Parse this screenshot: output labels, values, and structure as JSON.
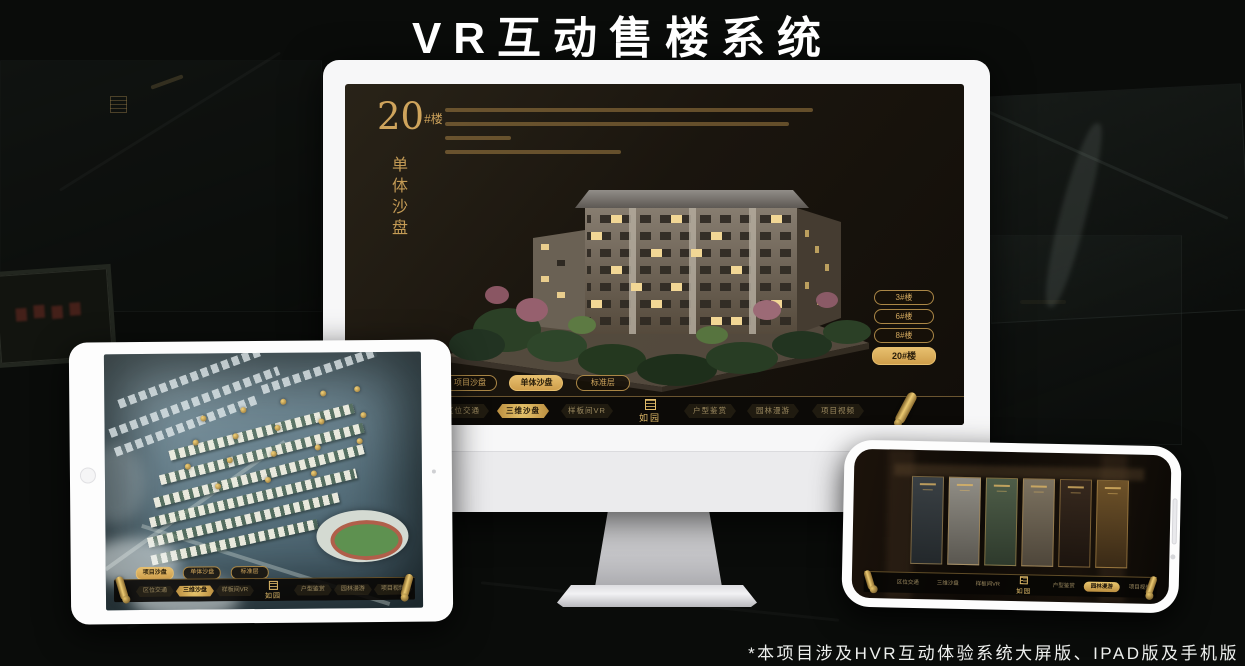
{
  "title": "VR互动售楼系统",
  "footnote": "*本项目涉及HVR互动体验系统大屏版、IPAD版及手机版",
  "logo": "如园",
  "colors": {
    "gold": "#d2a85e",
    "gold_bright": "#e9c76e",
    "active_text": "#1d1408",
    "screen_bg": "#1a150e"
  },
  "monitor": {
    "heading_number": "20",
    "heading_unit": "#楼",
    "heading_subtitle": "单体沙盘",
    "floor_buttons": [
      {
        "label": "3#楼",
        "active": false
      },
      {
        "label": "6#楼",
        "active": false
      },
      {
        "label": "8#楼",
        "active": false
      },
      {
        "label": "20#楼",
        "active": true
      }
    ],
    "mode_tabs": [
      {
        "label": "项目沙盘",
        "active": false
      },
      {
        "label": "单体沙盘",
        "active": true
      },
      {
        "label": "标准层",
        "active": false
      }
    ],
    "nav_left": [
      {
        "label": "区位交通",
        "active": false
      },
      {
        "label": "三维沙盘",
        "active": true
      },
      {
        "label": "样板间VR",
        "active": false
      }
    ],
    "nav_right": [
      {
        "label": "户型鉴赏",
        "active": false
      },
      {
        "label": "园林漫游",
        "active": false
      },
      {
        "label": "项目视频",
        "active": false
      }
    ]
  },
  "tablet": {
    "mode_tabs": [
      {
        "label": "项目沙盘",
        "active": true
      },
      {
        "label": "单体沙盘",
        "active": false
      },
      {
        "label": "标准层",
        "active": false
      }
    ],
    "nav_left": [
      {
        "label": "区位交通",
        "active": false
      },
      {
        "label": "三维沙盘",
        "active": true
      },
      {
        "label": "样板间VR",
        "active": false
      }
    ],
    "nav_right": [
      {
        "label": "户型鉴赏",
        "active": false
      },
      {
        "label": "园林漫游",
        "active": false
      },
      {
        "label": "项目视频",
        "active": false
      }
    ]
  },
  "phone": {
    "nav_left": [
      {
        "label": "区位交通",
        "active": false
      },
      {
        "label": "三维沙盘",
        "active": false
      },
      {
        "label": "样板间VR",
        "active": false
      }
    ],
    "nav_right": [
      {
        "label": "户型鉴赏",
        "active": false
      },
      {
        "label": "园林漫游",
        "active": true
      },
      {
        "label": "项目视频",
        "active": false
      }
    ]
  }
}
